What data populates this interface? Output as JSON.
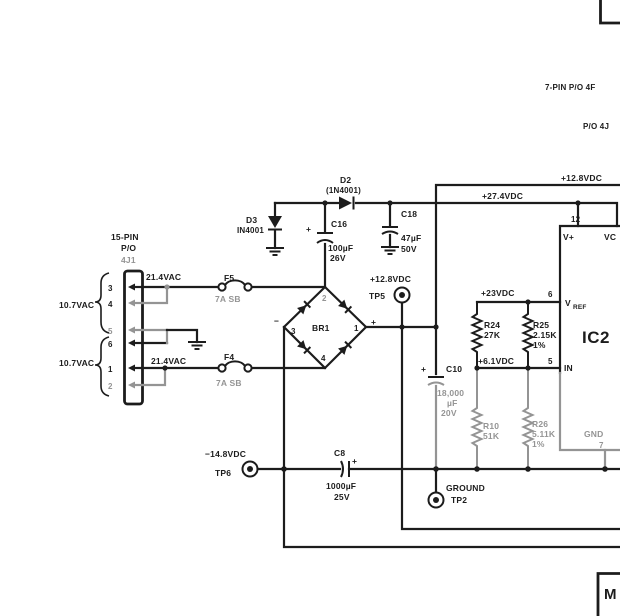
{
  "colors": {
    "ink": "#1c1c1c",
    "gray": "#949494",
    "background": "#ffffff"
  },
  "captions": {
    "seven_pin": "7-PIN P/O 4F",
    "po_4j": "P/O 4J"
  },
  "buses": {
    "v128": "+12.8VDC",
    "v274": "+27.4VDC"
  },
  "connector": {
    "title1": "15-PIN",
    "title2": "P/O",
    "title3": "4J1",
    "winding_top": "10.7VAC",
    "winding_bottom": "10.7VAC",
    "vac_top": "21.4VAC",
    "vac_bottom": "21.4VAC",
    "pins": [
      "3",
      "4",
      "5",
      "6",
      "1",
      "2"
    ]
  },
  "fuses": {
    "f5": {
      "name": "F5",
      "rating": "7A SB"
    },
    "f4": {
      "name": "F4",
      "rating": "7A SB"
    }
  },
  "bridge": {
    "name": "BR1",
    "pin_top": "2",
    "pin_left": "3",
    "pin_right": "1",
    "pin_bottom": "4",
    "minus": "−",
    "plus": "+"
  },
  "diodes": {
    "d2": {
      "name": "D2",
      "part": "(1N4001)"
    },
    "d3": {
      "name": "D3",
      "part": "IN4001"
    }
  },
  "caps": {
    "c16": {
      "name": "C16",
      "value": "100µF",
      "voltage": "26V",
      "plus": "+"
    },
    "c18": {
      "name": "C18",
      "value": "47µF",
      "voltage": "50V"
    },
    "c10": {
      "name": "C10",
      "value": "18,000",
      "unit": "µF",
      "voltage": "20V",
      "plus": "+"
    },
    "c8": {
      "name": "C8",
      "value": "1000µF",
      "voltage": "25V",
      "plus": "+"
    }
  },
  "resistors": {
    "r24": {
      "name": "R24",
      "value": "27K"
    },
    "r25": {
      "name": "R25",
      "value": "2.15K",
      "tol": "1%"
    },
    "r10": {
      "name": "R10",
      "value": "51K"
    },
    "r26": {
      "name": "R26",
      "value": "5.11K",
      "tol": "1%"
    }
  },
  "ic2": {
    "name": "IC2",
    "pin12": "12",
    "vplus": "V+",
    "vcc": "VC",
    "vref_v": "V",
    "vref_sub": "REF",
    "pin6": "6",
    "pin5": "5",
    "in_label": "IN",
    "gnd": "GND",
    "pin7": "7"
  },
  "nodes": {
    "v23": "+23VDC",
    "v61": "+6.1VDC",
    "v128_tp5": "+12.8VDC",
    "tp5": "TP5",
    "vneg": "−14.8VDC",
    "tp6": "TP6",
    "ground": "GROUND",
    "tp2": "TP2"
  },
  "module": {
    "label": "M"
  }
}
